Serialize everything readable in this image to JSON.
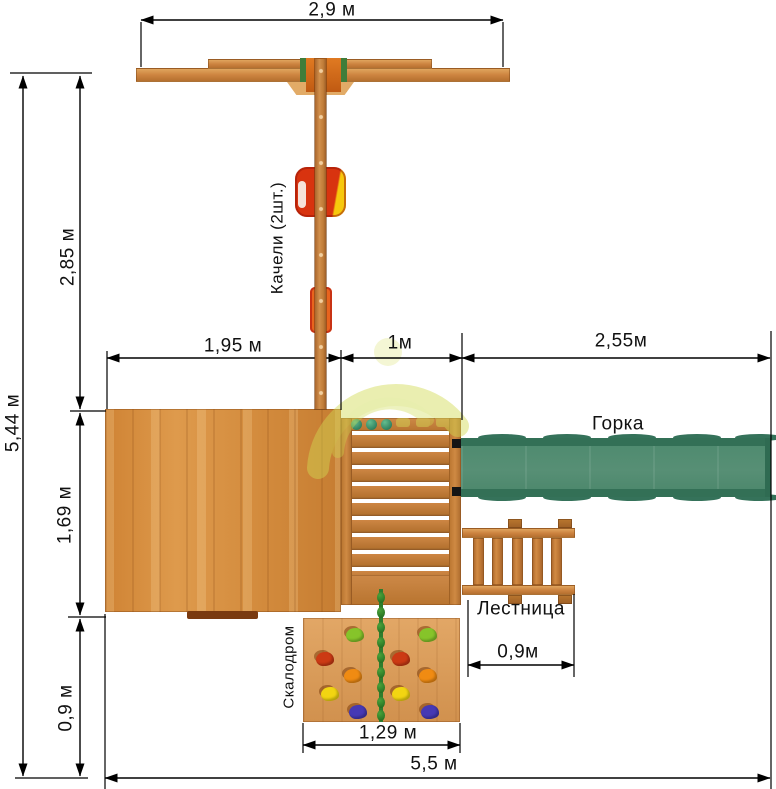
{
  "diagram": {
    "type": "playground-top-view-plan",
    "units": "м",
    "labels": {
      "swings": "Качели (2шт.)",
      "slide": "Горка",
      "ladder": "Лестница",
      "climbing_wall": "Скалодром"
    },
    "dimensions": {
      "swing_beam_width": "2,9 м",
      "overall_depth": "5,44 м",
      "swing_zone_depth": "2,85 м",
      "platform_width": "1,95 м",
      "tower_width": "1м",
      "slide_length": "2,55м",
      "platform_depth": "1,69 м",
      "climb_zone_depth": "0,9 м",
      "ladder_width": "0,9м",
      "climbing_wall_width": "1,29 м",
      "overall_width": "5,5 м"
    },
    "colors": {
      "wood": "#cd8441",
      "platform_wood": "#d8923f",
      "slide_green": "#4f8c71",
      "swing_seat_red": "#d53210",
      "swing_seat_yellow": "#f6c80a",
      "bracket_green": "#3f7d3a",
      "rope_green": "#2e7d2e",
      "hold_green": "#86c42a",
      "hold_red": "#cc3a14",
      "hold_orange": "#f08b12",
      "hold_yellow": "#f2d512",
      "hold_blue": "#4639b4",
      "dimension_line": "#000000",
      "watermark": "#d2da52"
    }
  }
}
